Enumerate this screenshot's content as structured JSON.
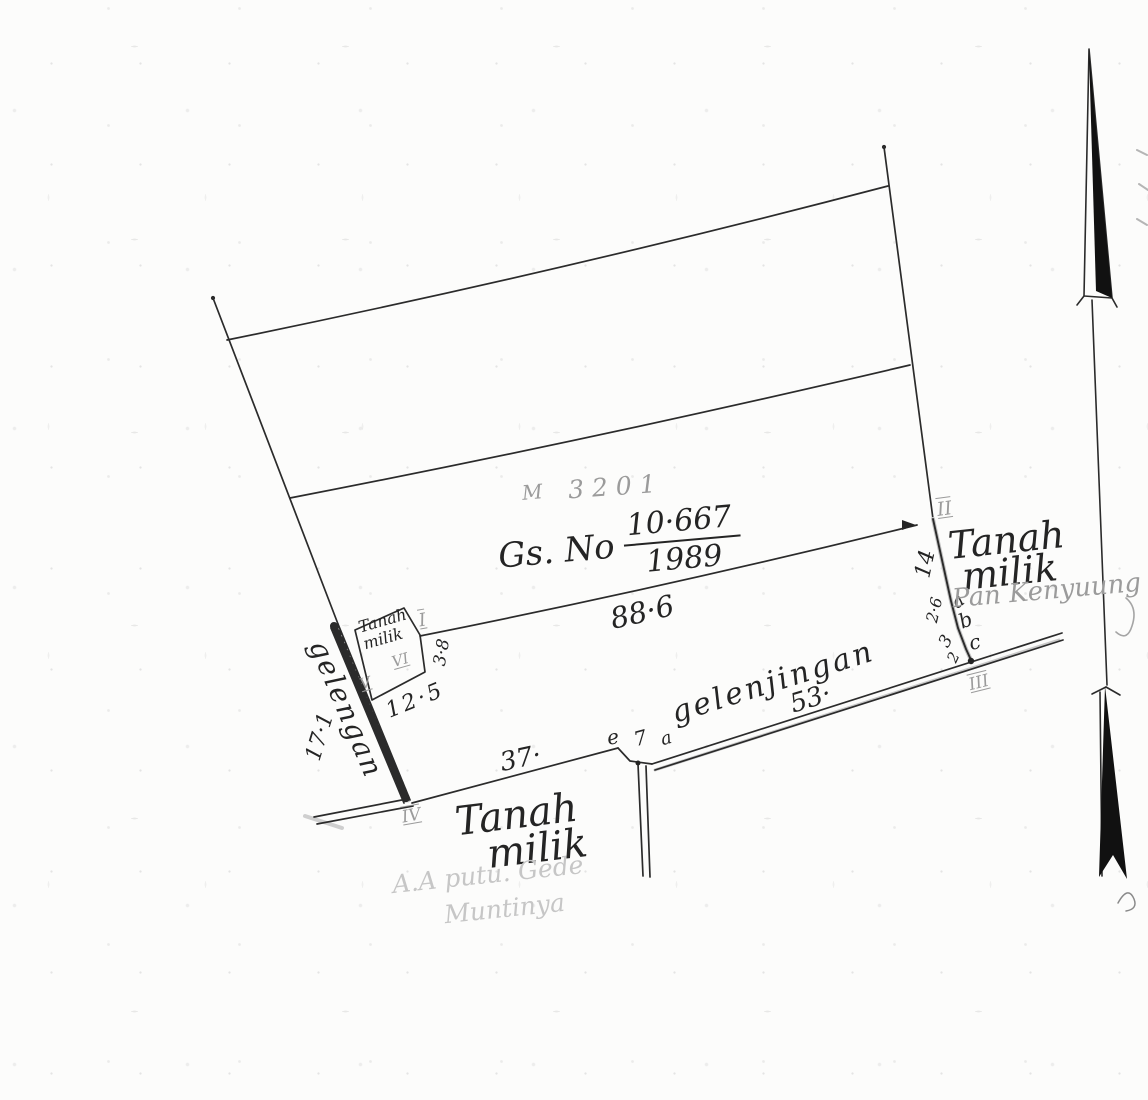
{
  "colors": {
    "ink": "#242424",
    "pencil": "#9b9b9b",
    "pencil_faint": "#c6c6c6",
    "paper": "#fcfcfb"
  },
  "annotations": {
    "m_number": {
      "prefix": "M",
      "value": "3201"
    },
    "gs_title": {
      "prefix": "Gs. No",
      "numerator": "10·667",
      "denominator": "1989"
    },
    "dimensions": {
      "top_width": "88·6",
      "right_segment": "14",
      "jog1": "2·6",
      "jog2": "3",
      "jog3": "2",
      "box_side": "3·8",
      "box_base": "12·5",
      "dike_length": "17·1",
      "road_west": "37·",
      "road_east": "53·",
      "notch_length": "7"
    },
    "points": {
      "a": "a",
      "b": "b",
      "c": "c",
      "e": "e",
      "notch_a": "a"
    },
    "roman": {
      "i": "I",
      "ii": "II",
      "iii": "III",
      "iv": "IV",
      "v": "V",
      "vi": "VI"
    },
    "owners": {
      "right": {
        "line1": "Tanah",
        "line2": "milik",
        "pencil_name": "Pan Kenyuung"
      },
      "bottom": {
        "line1": "Tanah",
        "line2": "milik",
        "pencil_line1": "A.A putu. Gede",
        "pencil_line2": "Muntinya"
      },
      "box": {
        "line1": "Tanah",
        "line2": "milik"
      }
    },
    "features": {
      "dike_name": "gelengan",
      "road_name": "gelenjingan"
    }
  }
}
